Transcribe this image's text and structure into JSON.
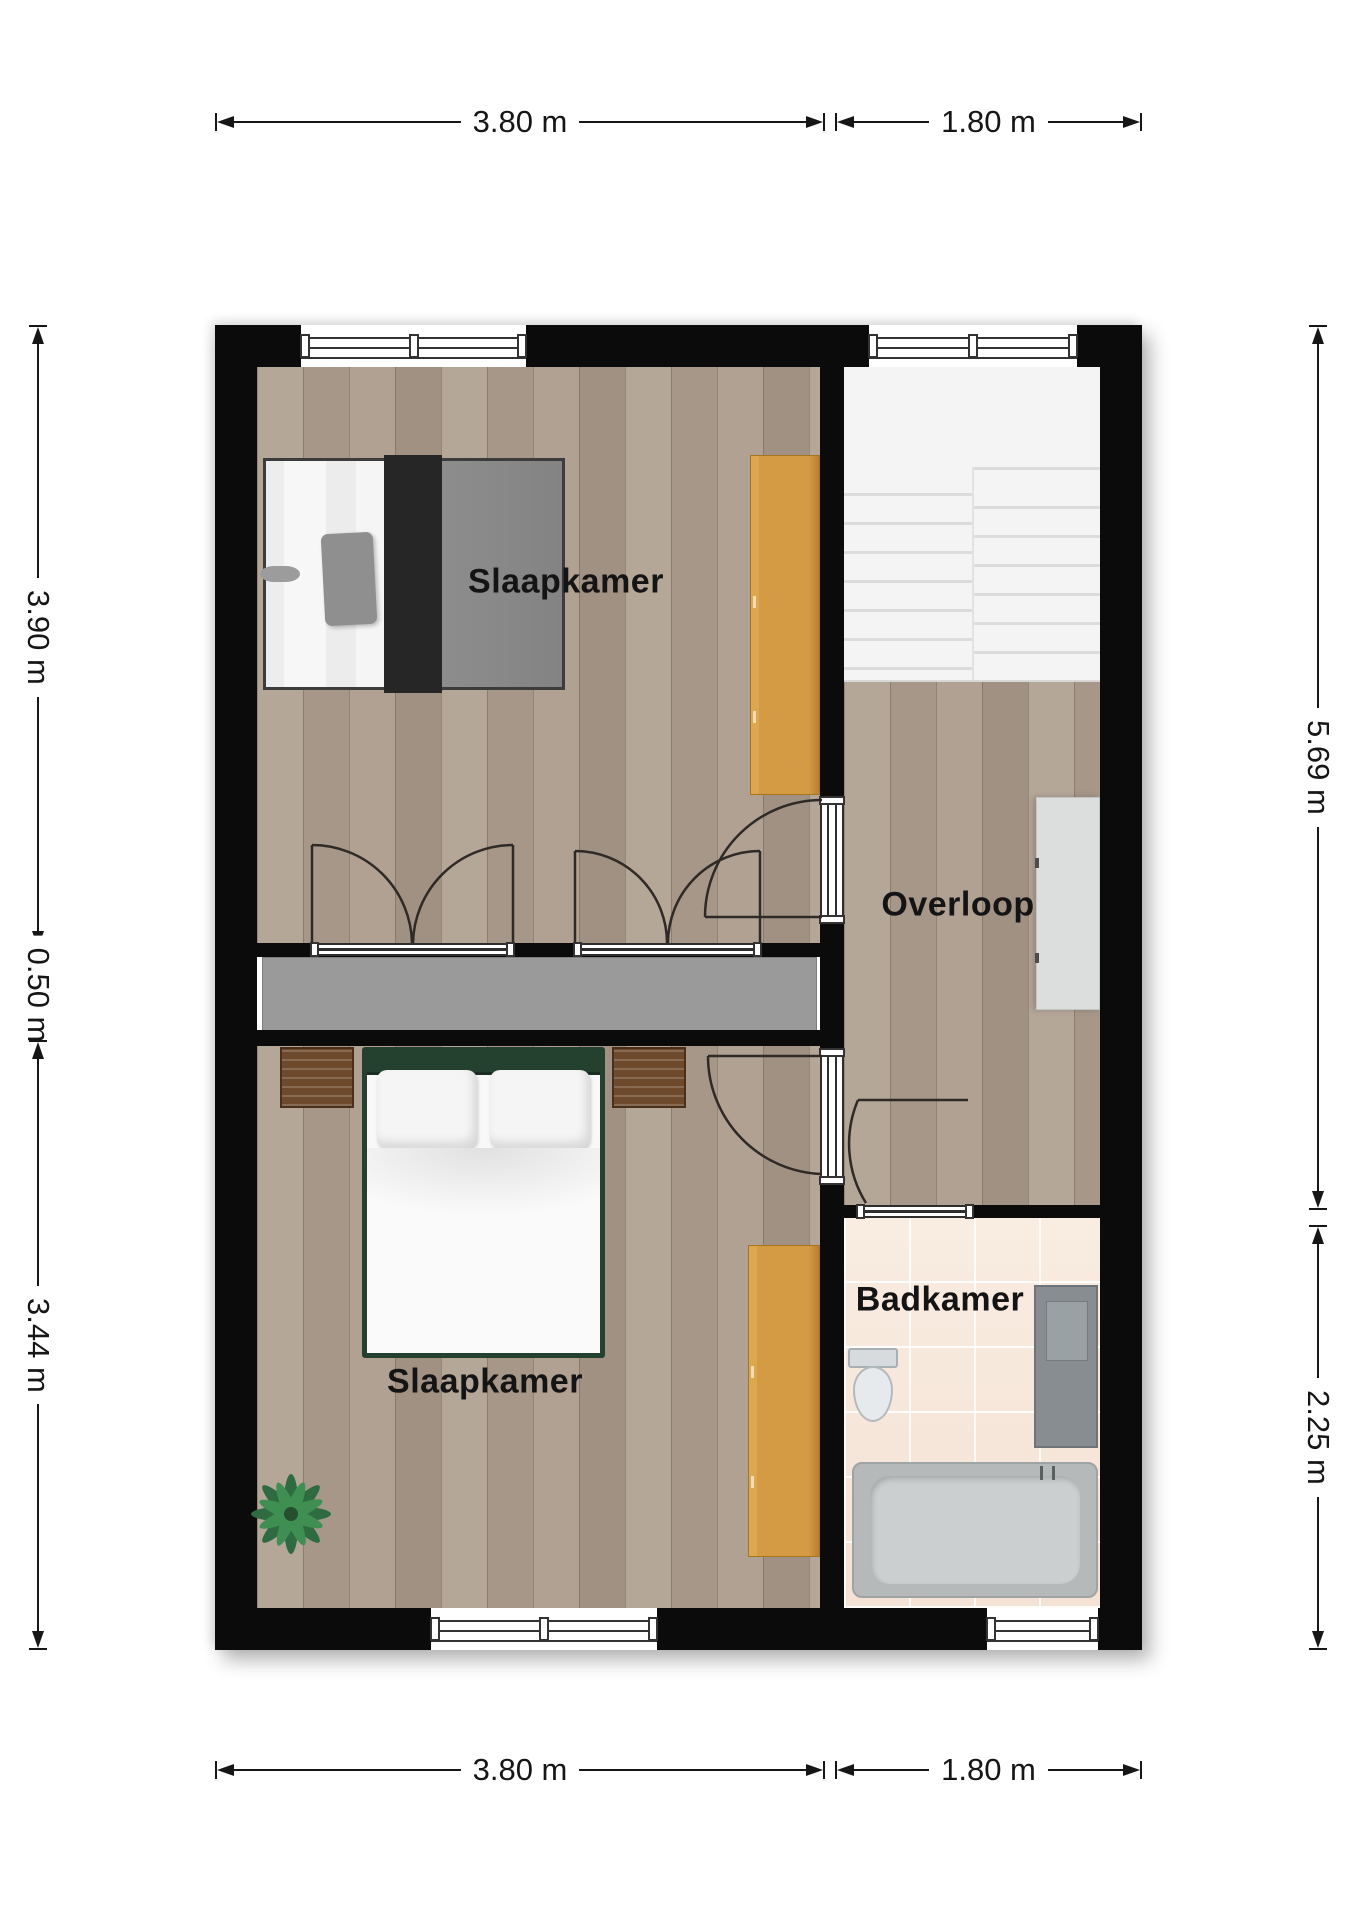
{
  "rooms": {
    "bedroom_top": {
      "label": "Slaapkamer"
    },
    "landing": {
      "label": "Overloop"
    },
    "bedroom_bottom": {
      "label": "Slaapkamer"
    },
    "bathroom": {
      "label": "Badkamer"
    }
  },
  "dimensions": {
    "top": [
      {
        "label": "3.80 m"
      },
      {
        "label": "1.80 m"
      }
    ],
    "bottom": [
      {
        "label": "3.80 m"
      },
      {
        "label": "1.80 m"
      }
    ],
    "left": [
      {
        "label": "3.90 m"
      },
      {
        "label": "0.50 m"
      },
      {
        "label": "3.44 m"
      }
    ],
    "right": [
      {
        "label": "5.69 m"
      },
      {
        "label": "2.25 m"
      }
    ]
  },
  "colors": {
    "wall": "#0b0b0b",
    "wood_floor": "#ac9d8e",
    "bathroom_floor": "#f7e9dd",
    "wardrobe": "#d49a44",
    "closet_unit": "#9a9a9a",
    "stairs": "#f4f4f4",
    "bed_frame_green": "#24402e",
    "dimension_text": "#161616"
  }
}
